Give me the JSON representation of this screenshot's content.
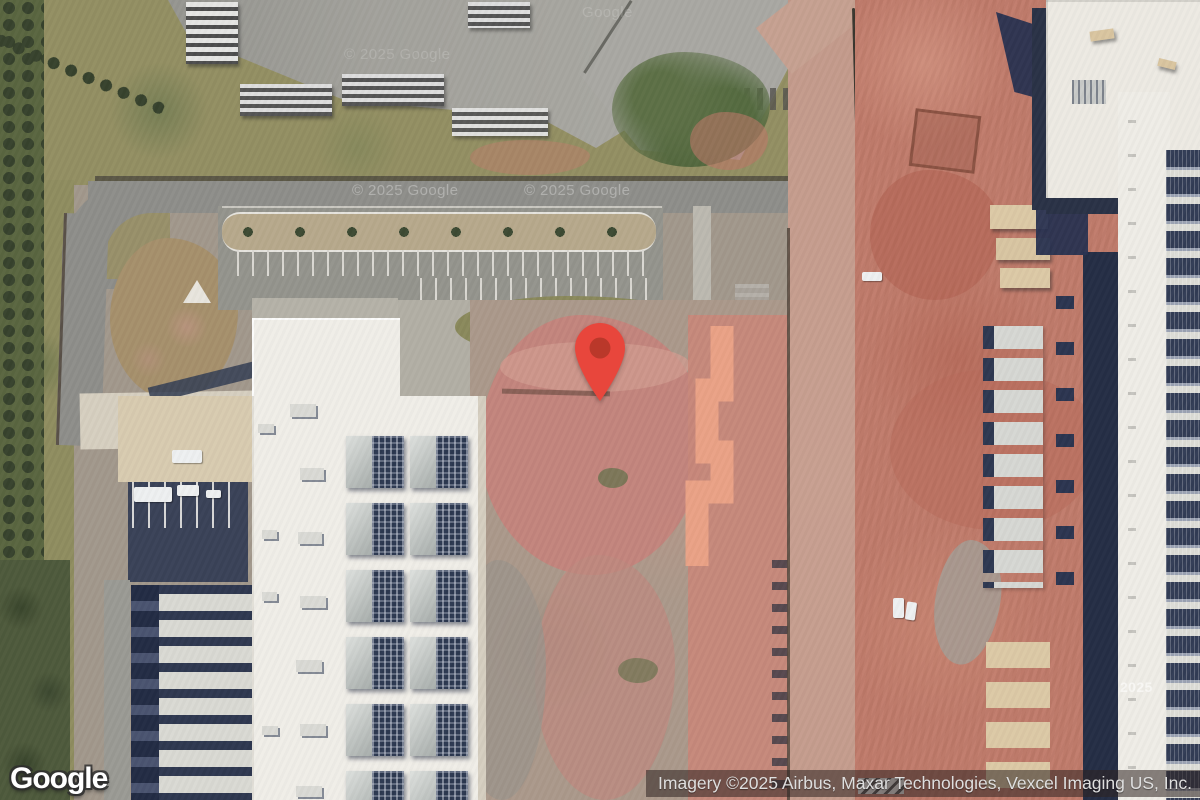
{
  "map": {
    "logo_text": "Google",
    "attribution_text": "Imagery ©2025 Airbus, Maxar Technologies, Vexcel Imaging US, Inc.",
    "watermark_full": "© 2025 Google",
    "watermark_year": "2025",
    "watermark_name": "Google",
    "pin": {
      "tip_x": 600,
      "tip_y": 400,
      "color": "#E8463C",
      "inner_color": "#B23627"
    },
    "colors": {
      "pin_red": "#E8463C",
      "attribution_bg": "rgba(45,35,32,0.55)",
      "attribution_text": "#DEDEDE",
      "clay_red": "#C07A6A",
      "graded_dirt_pink": "#C5837B",
      "boundary_highlight": "#ECA387",
      "roof_white": "#F0EEE8",
      "shadow_navy": "#2C3850",
      "asphalt_gray": "#8E8E8A",
      "grass_olive": "#938F63"
    }
  }
}
